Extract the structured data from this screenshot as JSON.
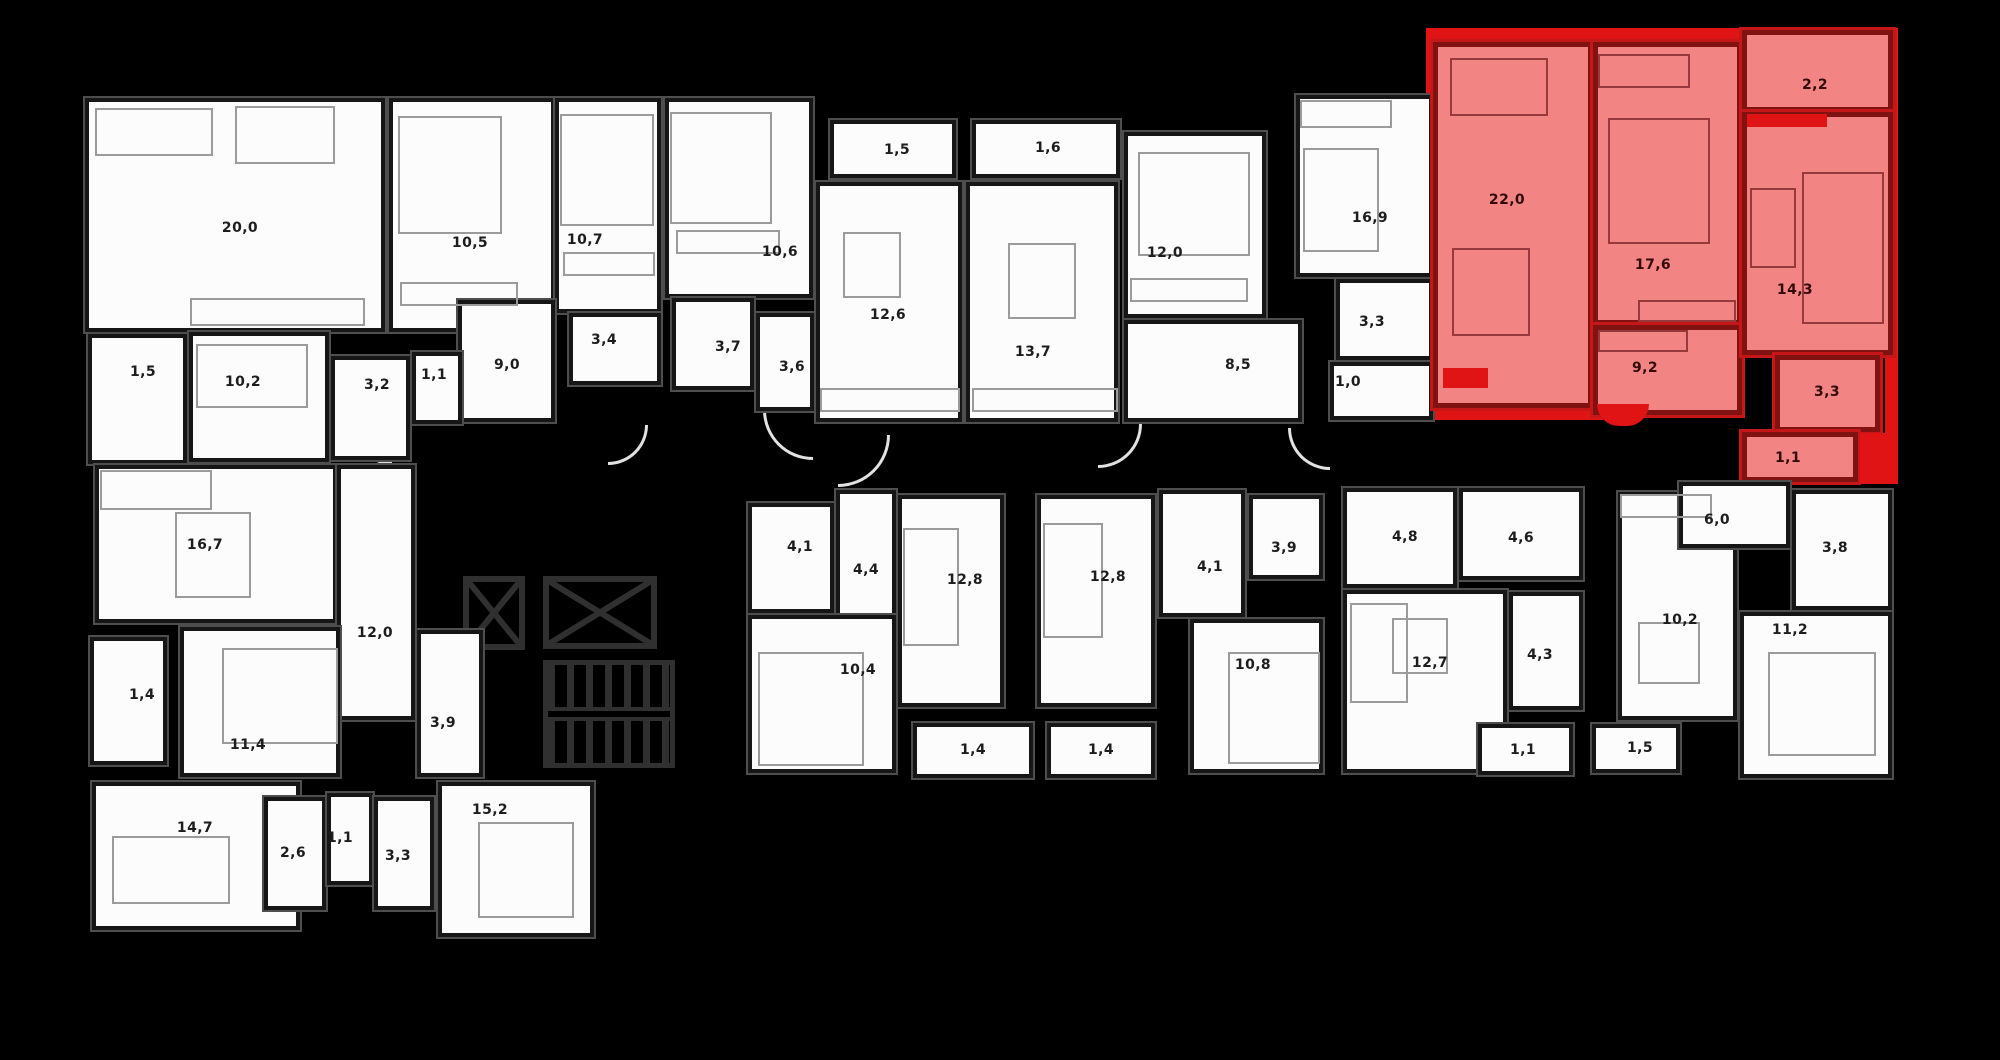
{
  "meta": {
    "type": "residential-floor-plan",
    "background_color": "#000000",
    "area_units": "m²",
    "decimal_separator": ","
  },
  "palette": {
    "room_fill": "#fcfcfc",
    "wall_color": "#161616",
    "plan_outline_color": "#4e4e4e",
    "highlight_room_fill": "#f38484",
    "highlight_wall_color": "#801212",
    "highlight_accent": "#e01414",
    "furniture_line_color": "#9b9b9b"
  },
  "highlighted_apartment": {
    "position": "top-right",
    "room_areas": [
      "22,0",
      "17,6",
      "2,2",
      "14,3",
      "9,2",
      "3,3",
      "1,1"
    ]
  },
  "core": {
    "elevators": 2,
    "staircase": true
  },
  "rooms": [
    {
      "id": "t-20-0",
      "area": "20,0",
      "x": 85,
      "y": 98,
      "w": 300,
      "h": 234,
      "lx": 240,
      "ly": 228
    },
    {
      "id": "t-10-5",
      "area": "10,5",
      "x": 389,
      "y": 98,
      "w": 166,
      "h": 234,
      "lx": 470,
      "ly": 243
    },
    {
      "id": "t-10-7",
      "area": "10,7",
      "x": 555,
      "y": 98,
      "w": 106,
      "h": 215,
      "lx": 585,
      "ly": 240
    },
    {
      "id": "t-3-4",
      "area": "3,4",
      "x": 569,
      "y": 313,
      "w": 92,
      "h": 72,
      "lx": 604,
      "ly": 340
    },
    {
      "id": "t-9-0",
      "area": "9,0",
      "x": 458,
      "y": 300,
      "w": 97,
      "h": 122,
      "lx": 507,
      "ly": 365
    },
    {
      "id": "t-10-6",
      "area": "10,6",
      "x": 665,
      "y": 98,
      "w": 148,
      "h": 200,
      "lx": 780,
      "ly": 252
    },
    {
      "id": "t-3-7",
      "area": "3,7",
      "x": 672,
      "y": 298,
      "w": 82,
      "h": 92,
      "lx": 728,
      "ly": 347
    },
    {
      "id": "t-3-6",
      "area": "3,6",
      "x": 756,
      "y": 313,
      "w": 58,
      "h": 98,
      "lx": 792,
      "ly": 367
    },
    {
      "id": "t-1-5b",
      "area": "1,5",
      "x": 830,
      "y": 120,
      "w": 126,
      "h": 58,
      "lx": 897,
      "ly": 150
    },
    {
      "id": "t-12-6",
      "area": "12,6",
      "x": 816,
      "y": 182,
      "w": 146,
      "h": 240,
      "lx": 888,
      "ly": 315
    },
    {
      "id": "t-1-6",
      "area": "1,6",
      "x": 972,
      "y": 120,
      "w": 148,
      "h": 58,
      "lx": 1048,
      "ly": 148
    },
    {
      "id": "t-13-7",
      "area": "13,7",
      "x": 966,
      "y": 182,
      "w": 152,
      "h": 240,
      "lx": 1033,
      "ly": 352
    },
    {
      "id": "t-12-0",
      "area": "12,0",
      "x": 1124,
      "y": 132,
      "w": 142,
      "h": 186,
      "lx": 1165,
      "ly": 253
    },
    {
      "id": "t-8-5",
      "area": "8,5",
      "x": 1124,
      "y": 320,
      "w": 178,
      "h": 102,
      "lx": 1238,
      "ly": 365
    },
    {
      "id": "t-16-9",
      "area": "16,9",
      "x": 1296,
      "y": 95,
      "w": 137,
      "h": 182,
      "lx": 1370,
      "ly": 218
    },
    {
      "id": "t-3-3",
      "area": "3,3",
      "x": 1336,
      "y": 279,
      "w": 97,
      "h": 81,
      "lx": 1372,
      "ly": 322
    },
    {
      "id": "t-1-0",
      "area": "1,0",
      "x": 1330,
      "y": 362,
      "w": 103,
      "h": 58,
      "lx": 1348,
      "ly": 382
    },
    {
      "id": "t-1-5a",
      "area": "1,5",
      "x": 88,
      "y": 334,
      "w": 99,
      "h": 130,
      "lx": 143,
      "ly": 372
    },
    {
      "id": "t-10-2",
      "area": "10,2",
      "x": 189,
      "y": 332,
      "w": 140,
      "h": 130,
      "lx": 243,
      "ly": 382
    },
    {
      "id": "t-3-2",
      "area": "3,2",
      "x": 331,
      "y": 356,
      "w": 79,
      "h": 104,
      "lx": 377,
      "ly": 385
    },
    {
      "id": "t-1-1",
      "area": "1,1",
      "x": 412,
      "y": 352,
      "w": 50,
      "h": 72,
      "lx": 434,
      "ly": 375
    },
    {
      "id": "r-22-0",
      "area": "22,0",
      "x": 1433,
      "y": 42,
      "w": 160,
      "h": 366,
      "hl": true,
      "lx": 1507,
      "ly": 200
    },
    {
      "id": "r-17-6",
      "area": "17,6",
      "x": 1593,
      "y": 42,
      "w": 149,
      "h": 283,
      "hl": true,
      "lx": 1653,
      "ly": 265
    },
    {
      "id": "r-9-2",
      "area": "9,2",
      "x": 1593,
      "y": 325,
      "w": 149,
      "h": 90,
      "hl": true,
      "lx": 1645,
      "ly": 368
    },
    {
      "id": "r-2-2",
      "area": "2,2",
      "x": 1742,
      "y": 30,
      "w": 151,
      "h": 82,
      "hl": true,
      "lx": 1815,
      "ly": 85
    },
    {
      "id": "r-14-3",
      "area": "14,3",
      "x": 1742,
      "y": 112,
      "w": 151,
      "h": 243,
      "hl": true,
      "lx": 1795,
      "ly": 290
    },
    {
      "id": "r-3-3",
      "area": "3,3",
      "x": 1775,
      "y": 355,
      "w": 105,
      "h": 77,
      "hl": true,
      "lx": 1827,
      "ly": 392
    },
    {
      "id": "r-1-1",
      "area": "1,1",
      "x": 1742,
      "y": 432,
      "w": 116,
      "h": 50,
      "hl": true,
      "lx": 1788,
      "ly": 458
    },
    {
      "id": "b-16-7",
      "area": "16,7",
      "x": 95,
      "y": 465,
      "w": 242,
      "h": 158,
      "lx": 205,
      "ly": 545
    },
    {
      "id": "b-12-0",
      "area": "12,0",
      "x": 337,
      "y": 465,
      "w": 78,
      "h": 255,
      "lx": 375,
      "ly": 633
    },
    {
      "id": "b-1-4",
      "area": "1,4",
      "x": 90,
      "y": 637,
      "w": 77,
      "h": 128,
      "lx": 142,
      "ly": 695
    },
    {
      "id": "b-11-4",
      "area": "11,4",
      "x": 180,
      "y": 627,
      "w": 160,
      "h": 150,
      "lx": 248,
      "ly": 745
    },
    {
      "id": "b-3-9",
      "area": "3,9",
      "x": 417,
      "y": 630,
      "w": 66,
      "h": 147,
      "lx": 443,
      "ly": 723
    },
    {
      "id": "b-14-7",
      "area": "14,7",
      "x": 92,
      "y": 782,
      "w": 208,
      "h": 148,
      "lx": 195,
      "ly": 828
    },
    {
      "id": "b-2-6",
      "area": "2,6",
      "x": 264,
      "y": 797,
      "w": 62,
      "h": 113,
      "lx": 293,
      "ly": 853
    },
    {
      "id": "b-1-1",
      "area": "1,1",
      "x": 327,
      "y": 793,
      "w": 46,
      "h": 92,
      "lx": 340,
      "ly": 838
    },
    {
      "id": "b-3-3",
      "area": "3,3",
      "x": 374,
      "y": 797,
      "w": 60,
      "h": 113,
      "lx": 398,
      "ly": 856
    },
    {
      "id": "b-15-2",
      "area": "15,2",
      "x": 438,
      "y": 782,
      "w": 156,
      "h": 155,
      "lx": 490,
      "ly": 810
    },
    {
      "id": "c-4-1a",
      "area": "4,1",
      "x": 748,
      "y": 503,
      "w": 86,
      "h": 110,
      "lx": 800,
      "ly": 547
    },
    {
      "id": "c-4-4",
      "area": "4,4",
      "x": 836,
      "y": 490,
      "w": 60,
      "h": 127,
      "lx": 866,
      "ly": 570
    },
    {
      "id": "c-12-8a",
      "area": "12,8",
      "x": 898,
      "y": 495,
      "w": 106,
      "h": 212,
      "lx": 965,
      "ly": 580
    },
    {
      "id": "c-10-4",
      "area": "10,4",
      "x": 748,
      "y": 615,
      "w": 148,
      "h": 158,
      "lx": 858,
      "ly": 670
    },
    {
      "id": "c-1-4a",
      "area": "1,4",
      "x": 913,
      "y": 723,
      "w": 120,
      "h": 55,
      "lx": 973,
      "ly": 750
    },
    {
      "id": "c-12-8b",
      "area": "12,8",
      "x": 1037,
      "y": 495,
      "w": 118,
      "h": 212,
      "lx": 1108,
      "ly": 577
    },
    {
      "id": "c-4-1b",
      "area": "4,1",
      "x": 1159,
      "y": 490,
      "w": 86,
      "h": 127,
      "lx": 1210,
      "ly": 567
    },
    {
      "id": "c-3-9",
      "area": "3,9",
      "x": 1249,
      "y": 495,
      "w": 74,
      "h": 84,
      "lx": 1284,
      "ly": 548
    },
    {
      "id": "c-10-8",
      "area": "10,8",
      "x": 1190,
      "y": 619,
      "w": 133,
      "h": 154,
      "lx": 1253,
      "ly": 665
    },
    {
      "id": "c-1-4b",
      "area": "1,4",
      "x": 1047,
      "y": 723,
      "w": 108,
      "h": 55,
      "lx": 1101,
      "ly": 750
    },
    {
      "id": "d-4-8",
      "area": "4,8",
      "x": 1343,
      "y": 488,
      "w": 114,
      "h": 100,
      "lx": 1405,
      "ly": 537
    },
    {
      "id": "d-4-6",
      "area": "4,6",
      "x": 1459,
      "y": 488,
      "w": 124,
      "h": 92,
      "lx": 1521,
      "ly": 538
    },
    {
      "id": "d-12-7",
      "area": "12,7",
      "x": 1343,
      "y": 590,
      "w": 164,
      "h": 183,
      "lx": 1430,
      "ly": 663
    },
    {
      "id": "d-4-3",
      "area": "4,3",
      "x": 1509,
      "y": 592,
      "w": 74,
      "h": 118,
      "lx": 1540,
      "ly": 655
    },
    {
      "id": "d-1-1",
      "area": "1,1",
      "x": 1478,
      "y": 724,
      "w": 95,
      "h": 51,
      "lx": 1523,
      "ly": 750
    },
    {
      "id": "d-1-5",
      "area": "1,5",
      "x": 1592,
      "y": 724,
      "w": 88,
      "h": 49,
      "lx": 1640,
      "ly": 748
    },
    {
      "id": "d-10-2",
      "area": "10,2",
      "x": 1618,
      "y": 492,
      "w": 119,
      "h": 228,
      "lx": 1680,
      "ly": 620
    },
    {
      "id": "d-6-0",
      "area": "6,0",
      "x": 1679,
      "y": 482,
      "w": 111,
      "h": 66,
      "lx": 1717,
      "ly": 520
    },
    {
      "id": "d-3-8",
      "area": "3,8",
      "x": 1792,
      "y": 490,
      "w": 100,
      "h": 120,
      "lx": 1835,
      "ly": 548
    },
    {
      "id": "d-11-2",
      "area": "11,2",
      "x": 1740,
      "y": 612,
      "w": 152,
      "h": 166,
      "lx": 1790,
      "ly": 630
    }
  ]
}
